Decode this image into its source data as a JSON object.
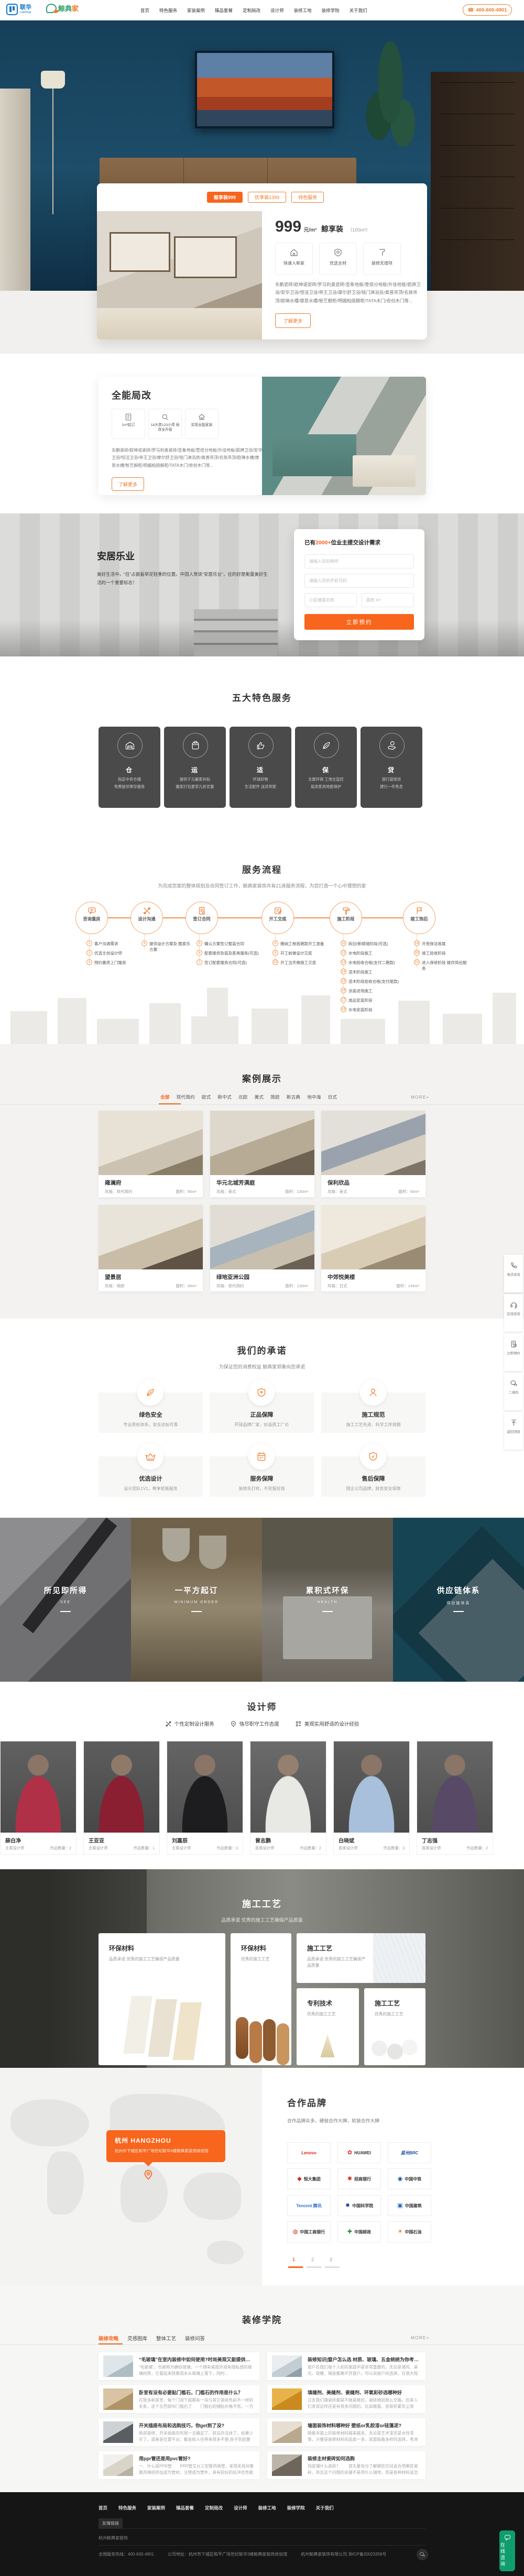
{
  "accent_color": "#f8651c",
  "header": {
    "logo_cn": "联华",
    "logo_en": "Lianhua",
    "logo2_cn": "鲸典",
    "logo2_jia": "家",
    "nav": [
      "首页",
      "特色服务",
      "家装案例",
      "臻品套餐",
      "定制局改",
      "设计师",
      "装修工地",
      "装修学院",
      "关于我们"
    ],
    "phone": "400-600-4901"
  },
  "hero": {
    "tabs": [
      "鲸享装999",
      "优享装1399",
      "特色服务"
    ],
    "price": "999",
    "price_unit": "元/m²",
    "price_name": "鲸享装",
    "price_note": "（100m²）",
    "features": [
      "快速入新家",
      "优选主材",
      "装修无增项"
    ],
    "desc": "东鹏瓷砖/欧神诺瓷砖/罗马利奥瓷砖/圣象地板/壹佰分地板/升佳地板/箭牌卫浴/安华卫浴/恒洁卫浴/帝王卫浴/摩尔舒卫浴/铭门淋浴房/奥普吊顶/名族吊顶/欧琳水槽/摩恩水槽/智艺橱柜/明媚柏丽橱柜/TATA木门/奇创木门等...",
    "more": "了解更多"
  },
  "reno": {
    "title": "全能局改",
    "features": [
      "1m²起订",
      "18大类120小项 局改全升级",
      "实现全能家装"
    ],
    "desc": "东鹏瓷砖/欧神诺瓷砖/罗马利奥瓷砖/圣象地板/壹佰分地板/升佳地板/箭牌卫浴/安华卫浴/恒洁卫浴/帝王卫浴/摩尔舒卫浴/铭门淋浴房/奥普吊顶/名族吊顶/欧琳水槽/摩恩水槽/智艺橱柜/明媚柏丽橱柜/TATA木门/奇创木门等...",
    "more": "了解更多"
  },
  "living": {
    "title": "安居乐业",
    "desc": "美好生活中，“住”占据着举足轻重的位置。中国人常说“安居乐业”，住的好是衡量美好生活的一个重要标志！",
    "form": {
      "title_prefix": "已有",
      "title_count": "2000+",
      "title_suffix": "位业主提交设计需求",
      "name_ph": "请输入您的称呼",
      "phone_ph": "请输入您的手机号码",
      "estate_ph": "小区楼盘名称",
      "area_ph": "面积 m²",
      "submit": "立即预约"
    }
  },
  "services": {
    "title": "五大特色服务",
    "items": [
      {
        "char": "仓",
        "line1": "指定中央仓储",
        "line2": "免费提供寄存服务"
      },
      {
        "char": "运",
        "line1": "提供千元搬家补贴",
        "line2": "搬家打包更享九折优惠"
      },
      {
        "char": "适",
        "line1": "环球好物",
        "line2": "生活配件 送货到家"
      },
      {
        "char": "保",
        "line1": "全屋环保 工地全监控",
        "line2": "局改家具地面保护"
      },
      {
        "char": "贷",
        "line1": "银行装修贷",
        "line2": "建行一年免息"
      }
    ]
  },
  "process": {
    "title": "服务流程",
    "subtitle": "为完成您家的整体规划及合同签订工作，鲸典家装饰共有21道服务流程，为您打造一个心中理想的家",
    "stages": [
      {
        "label": "咨询量房",
        "steps": [
          {
            "n": "1",
            "t": "客户沟通需求"
          },
          {
            "n": "2",
            "t": "优选主创设计师"
          },
          {
            "n": "3",
            "t": "预约量房上门服务"
          }
        ]
      },
      {
        "label": "设计沟通",
        "steps": [
          {
            "n": "4",
            "t": "提供设计方案及 酷家乐方案"
          }
        ]
      },
      {
        "label": "签订合同",
        "steps": [
          {
            "n": "5",
            "t": "确认方案签订整装合同"
          },
          {
            "n": "6",
            "t": "配套提供软装及家具服务(可选)"
          },
          {
            "n": "7",
            "t": "签订配套服务合同(可选)"
          }
        ]
      },
      {
        "label": "开工交底",
        "steps": [
          {
            "n": "8",
            "t": "缴纳工程首期款开工准备"
          },
          {
            "n": "9",
            "t": "开工前做设计交底"
          },
          {
            "n": "10",
            "t": "开工当天做施工交底"
          }
        ]
      },
      {
        "label": "施工阶段",
        "steps": [
          {
            "n": "11",
            "t": "拆旧/新砌墙阶段(可选)"
          },
          {
            "n": "12",
            "t": "水电阶段施工"
          },
          {
            "n": "13",
            "t": "水电验收合格(支付二期款)"
          },
          {
            "n": "14",
            "t": "泥木阶段施工"
          },
          {
            "n": "15",
            "t": "泥木阶段验收合格(支付尾款)"
          },
          {
            "n": "16",
            "t": "涂装进场施工"
          },
          {
            "n": "17",
            "t": "成品安装阶段"
          },
          {
            "n": "18",
            "t": "水电安装阶段"
          }
        ]
      },
      {
        "label": "竣工饰后",
        "steps": [
          {
            "n": "19",
            "t": "开荒保洁收尾"
          },
          {
            "n": "20",
            "t": "竣工验收阶段"
          },
          {
            "n": "21",
            "t": "进入保修阶段 提供饰后服务"
          }
        ]
      }
    ]
  },
  "cases": {
    "title": "案例展示",
    "tabs": [
      "全部",
      "现代简约",
      "欧式",
      "新中式",
      "北欧",
      "美式",
      "简欧",
      "新古典",
      "地中海",
      "日式"
    ],
    "more": "MORE+",
    "style_label": "风格：",
    "area_label": "面积：",
    "items": [
      {
        "name": "雍澜府",
        "style": "现代简约",
        "area": "90m²"
      },
      {
        "name": "华元北城芳满庭",
        "style": "美式",
        "area": "130m²"
      },
      {
        "name": "保利欣品",
        "style": "美式",
        "area": "90m²"
      },
      {
        "name": "望景居",
        "style": "简欧",
        "area": "90m²"
      },
      {
        "name": "绿地亚洲公园",
        "style": "现代简约",
        "area": "130m²"
      },
      {
        "name": "中郊悦美楼",
        "style": "日式",
        "area": "145m²"
      }
    ]
  },
  "promise": {
    "title": "我们的承诺",
    "subtitle": "为保证您的消费权益 鲸典家郑重向您承诺",
    "items": [
      {
        "title": "绿色安全",
        "desc": "专业质检体系，安全达标可靠"
      },
      {
        "title": "正品保障",
        "desc": "环球品牌厂家，好品质工厂价"
      },
      {
        "title": "施工规范",
        "desc": "施工工艺先进，科学工序排期"
      },
      {
        "title": "优选设计",
        "desc": "设计团队1V1，尊享软装服务"
      },
      {
        "title": "服务保障",
        "desc": "装修先打样，不花冤枉钱"
      },
      {
        "title": "售后保障",
        "desc": "国企公司品牌，财务安全保障"
      }
    ]
  },
  "strip": {
    "items": [
      {
        "title": "所见即所得",
        "sub": "SEE"
      },
      {
        "title": "一平方起订",
        "sub": "MINIMUM ORDER"
      },
      {
        "title": "累积式环保",
        "sub": "HEALTH"
      },
      {
        "title": "供应链体系",
        "sub": "供应链体系"
      }
    ]
  },
  "designers": {
    "title": "设计师",
    "features": [
      "个性定制设计服务",
      "恪尽职守工作态度",
      "美观实用舒适的设计经验"
    ],
    "works_label": "作品数量：",
    "items": [
      {
        "name": "薛白净",
        "role": "主案设计师",
        "works": "2"
      },
      {
        "name": "王亚亚",
        "role": "主案设计师",
        "works": "1"
      },
      {
        "name": "刘嘉辰",
        "role": "主案设计师",
        "works": "0"
      },
      {
        "name": "曾志鹏",
        "role": "首席设计师",
        "works": "2"
      },
      {
        "name": "白晓斌",
        "role": "首席设计师",
        "works": "3"
      },
      {
        "name": "丁志强",
        "role": "首席设计师",
        "works": "2"
      }
    ]
  },
  "craft": {
    "title": "施工工艺",
    "subtitle": "品质承诺 优秀的施工工艺确保产品质量",
    "cards": [
      {
        "title": "环保材料",
        "desc": "品质承诺 优秀的施工工艺确保产品质量"
      },
      {
        "title": "环保材料",
        "desc": "优秀的施工工艺"
      },
      {
        "title": "施工工艺",
        "desc": "品质承诺 优秀的施工工艺确保产品质量"
      },
      {
        "title": "专利技术",
        "desc": "优秀的施工工艺"
      },
      {
        "title": "施工工艺",
        "desc": "优秀的施工工艺"
      }
    ]
  },
  "brands": {
    "title": "合作品牌",
    "subtitle": "合作品牌众多，硬装合作大牌，软装合作大牌",
    "map_city": "杭州 HANGZHOU",
    "map_address": "杭州市下城区和平广场世纪联华3楼鲸典家装饰体验馆",
    "logos": [
      {
        "name": "Lenovo",
        "glyph": "",
        "color": "#e2231a"
      },
      {
        "name": "HUAWEI",
        "glyph": "✿",
        "color": "#e2231a"
      },
      {
        "name": "蓝光BRC",
        "glyph": "",
        "color": "#1a50a2"
      },
      {
        "name": "恒大集团",
        "glyph": "◆",
        "color": "#d42a1e"
      },
      {
        "name": "招商银行",
        "glyph": "✱",
        "color": "#d42a1e"
      },
      {
        "name": "中国中铁",
        "glyph": "◉",
        "color": "#1a50a2"
      },
      {
        "name": "Tencent 腾讯",
        "glyph": "",
        "color": "#2a6fd0"
      },
      {
        "name": "中国科学院",
        "glyph": "✹",
        "color": "#1a50a2"
      },
      {
        "name": "中国建筑",
        "glyph": "▣",
        "color": "#1a63b8"
      },
      {
        "name": "中国工商银行",
        "glyph": "◍",
        "color": "#d42a1e"
      },
      {
        "name": "中国邮政",
        "glyph": "✚",
        "color": "#1e8a3c"
      },
      {
        "name": "中国石油",
        "glyph": "☀",
        "color": "#e06a10"
      }
    ],
    "pages": [
      "1",
      "2",
      "3"
    ]
  },
  "academy": {
    "title": "装修学院",
    "tabs": [
      "装修攻略",
      "灵感图库",
      "整体工艺",
      "装修问答"
    ],
    "more": "MORE+",
    "articles": [
      {
        "title": "“毛玻璃”在室内装修中如何使用?时尚美观又能提供隐私感",
        "excerpt": "“毛玻璃”，也被称为磨砂玻璃，一个拥有美图外观有隐私感的玻璃材质，它看起来就像雨水从玻璃上落下，同时..."
      },
      {
        "title": "装修知识|窗户怎么选 材质、玻璃、五金统统为你考虑到",
        "excerpt": "窗户在我们每个人的的家庭中是非常重要的，无论是通风、采光、保暖、隔音都离不开窗户。可以说窗户的选择，在很大程度上决定..."
      },
      {
        "title": "卧室有没有必要贴门槛石，门槛石的作用是什么？",
        "excerpt": "在很多新房里，每个门洞下面都有一块与其它瓷砖色彩不一样的长条，这个东西就叫门槛石了　　门槛石的铺贴价格不低，一方面..."
      },
      {
        "title": "填缝剂、美缝剂、瓷缝剂、环氧彩砂选哪种好",
        "excerpt": "过去我们铺瓷砖都是不做美缝的，瓷砖缝就那么空着。后来人们发现这样还是有很多问题的，比如难看、容易积累灰尘等等，所以现..."
      },
      {
        "title": "开关插座布局和选购技巧，你get到了没?",
        "excerpt": "新房装修，开关插座的布局一旦确定了，就没办法改了，如果少买了，或者是位置不对，都会给入住带来很多不便,房子到底要安装..."
      },
      {
        "title": "墙面装饰材料哪种好 壁纸or乳胶漆or硅藻泥?",
        "excerpt": "随着市面上的装修材料越来越多，无论是艺术漆还是水性漆等，只要是装修材料的品类一多，就面临着多样的选择，考虑众多的材料..."
      },
      {
        "title": "用ppr管还是用pvc管好?",
        "excerpt": "一、什么是PPR管　　PPR管又以三型聚丙烯管，采用无规共聚聚丙烯经挤出成为管材，注塑成为管件，具有较好的抗冲击性能和长..."
      },
      {
        "title": "装修主材瓷砖如何选购",
        "excerpt": "到底铺什么瓷砖？　　首先要充分了解哪些空间适合用哪些瓷砖，其实这个问题的关键不是用什么铺地，而是各种材料该怎么搭配。..."
      }
    ]
  },
  "footer": {
    "nav": [
      "首页",
      "特色服务",
      "家装案例",
      "臻品套餐",
      "定制局改",
      "设计师",
      "装修工地",
      "装修学院",
      "关于我们"
    ],
    "links_tab": "友情链接",
    "link": "杭州鲸典家装饰",
    "hotline": "全国服务热线：400-600-4901",
    "address": "公司地址：杭州市下城区和平广场世纪联华3楼鲸典家装饰体验馆",
    "company": "杭州鲸典家装饰有限公司  浙ICP备20023358号"
  },
  "floating": {
    "items": [
      "电话咨询",
      "在线咨询",
      "立即预约",
      "二维码",
      "返回顶部"
    ],
    "consult": "在线咨询"
  },
  "icons": {
    "phone_glyph": "☎"
  }
}
